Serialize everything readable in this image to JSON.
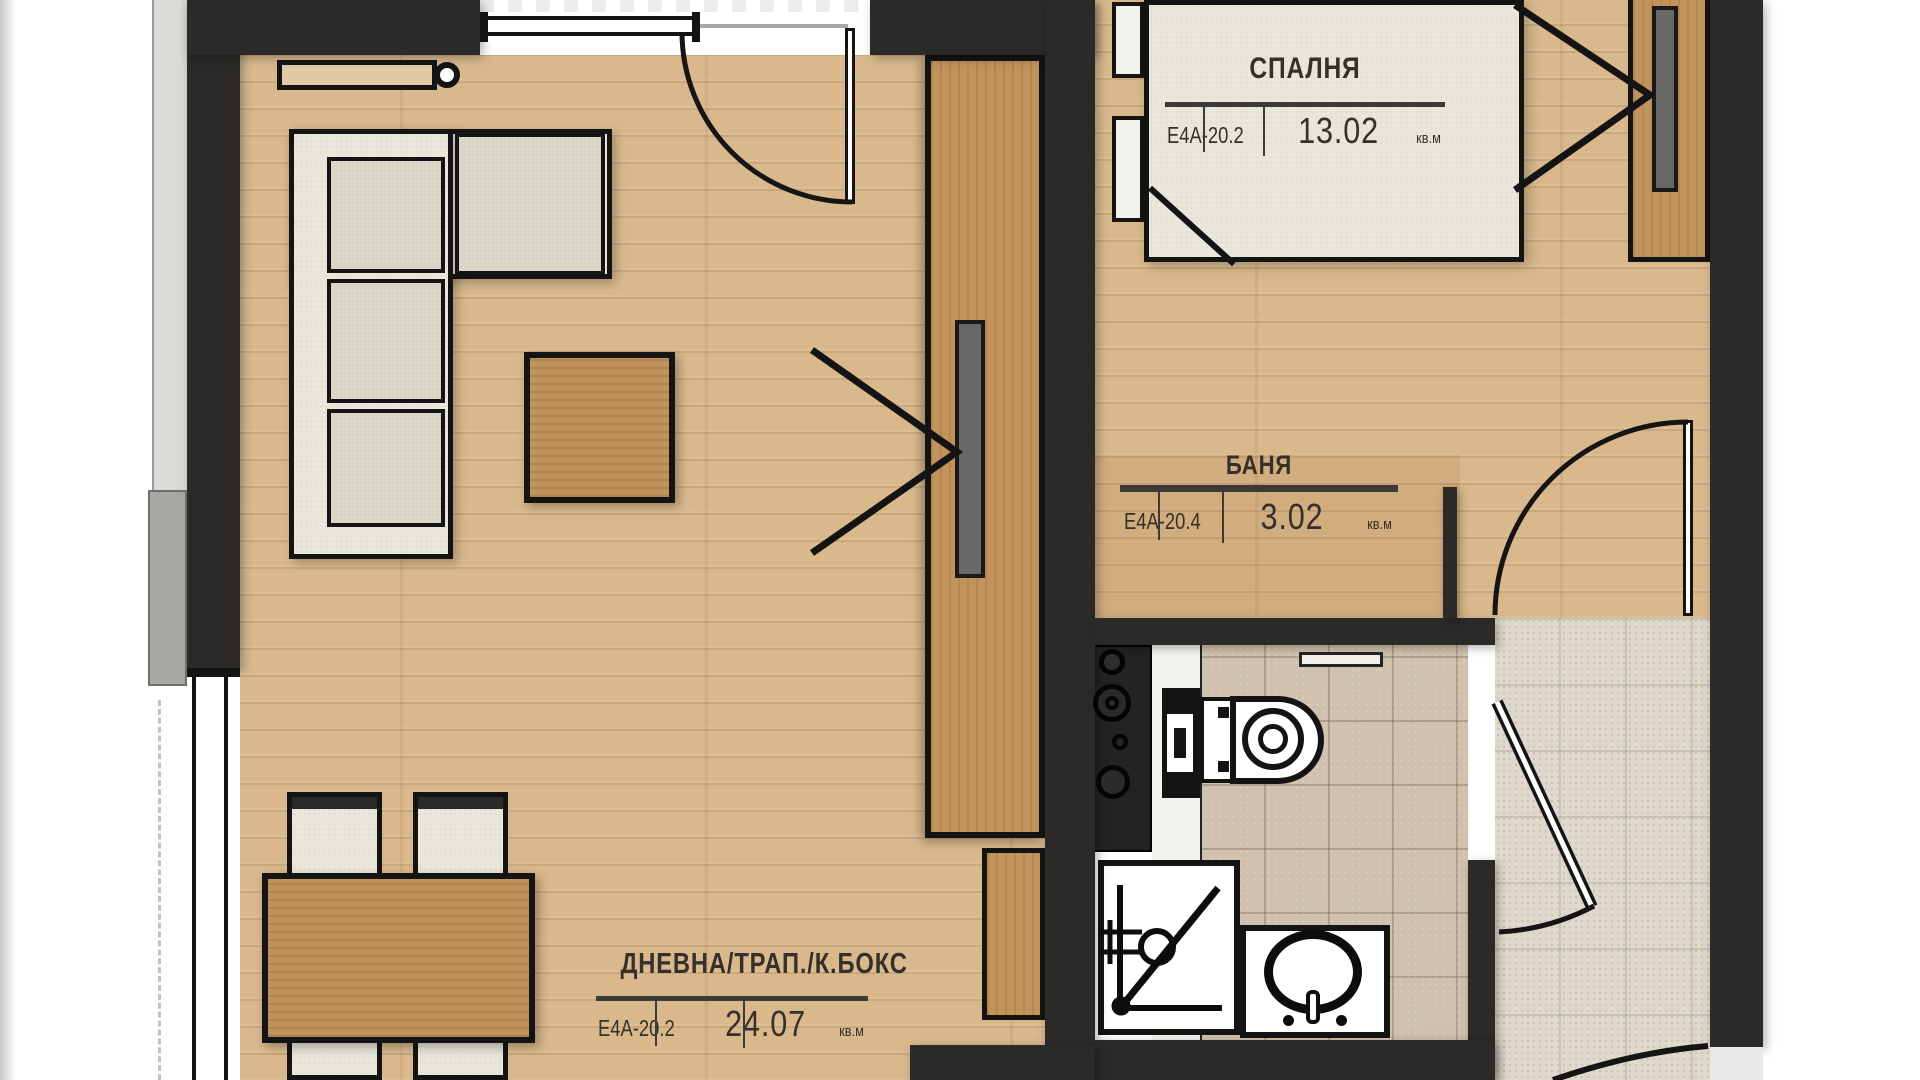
{
  "plan": {
    "type": "apartment-floor-plan",
    "language": "bg",
    "rooms": [
      {
        "id": "bedroom",
        "name": "СПАЛНЯ",
        "code": "Е4А-20.2",
        "area": "13.02",
        "unit": "кв.м"
      },
      {
        "id": "bath",
        "name": "БАНЯ",
        "code": "Е4А-20.4",
        "area": "3.02",
        "unit": "кв.м"
      },
      {
        "id": "living",
        "name": "ДНЕВНА/ТРАП./К.БОКС",
        "code": "Е4А-20.2",
        "area": "24.07",
        "unit": "кв.м"
      }
    ],
    "furniture": [
      "corner-sofa",
      "coffee-table",
      "dining-table",
      "dining-chairs",
      "radiator",
      "tall-cabinet",
      "entry-closet",
      "double-bed",
      "nightstands",
      "wardrobe",
      "kitchen-stove",
      "toilet",
      "shower-tray",
      "washbasin"
    ],
    "colors": {
      "wall": "#2b2a28",
      "floor_wood": "#d9b98c",
      "cabinet_wood": "#c2935b",
      "upholstery": "#e9e6dc",
      "bath_tile": "#cfc1ad",
      "hall_tile": "#ded9cc",
      "outline": "#141414",
      "label_text": "#35302b"
    }
  }
}
